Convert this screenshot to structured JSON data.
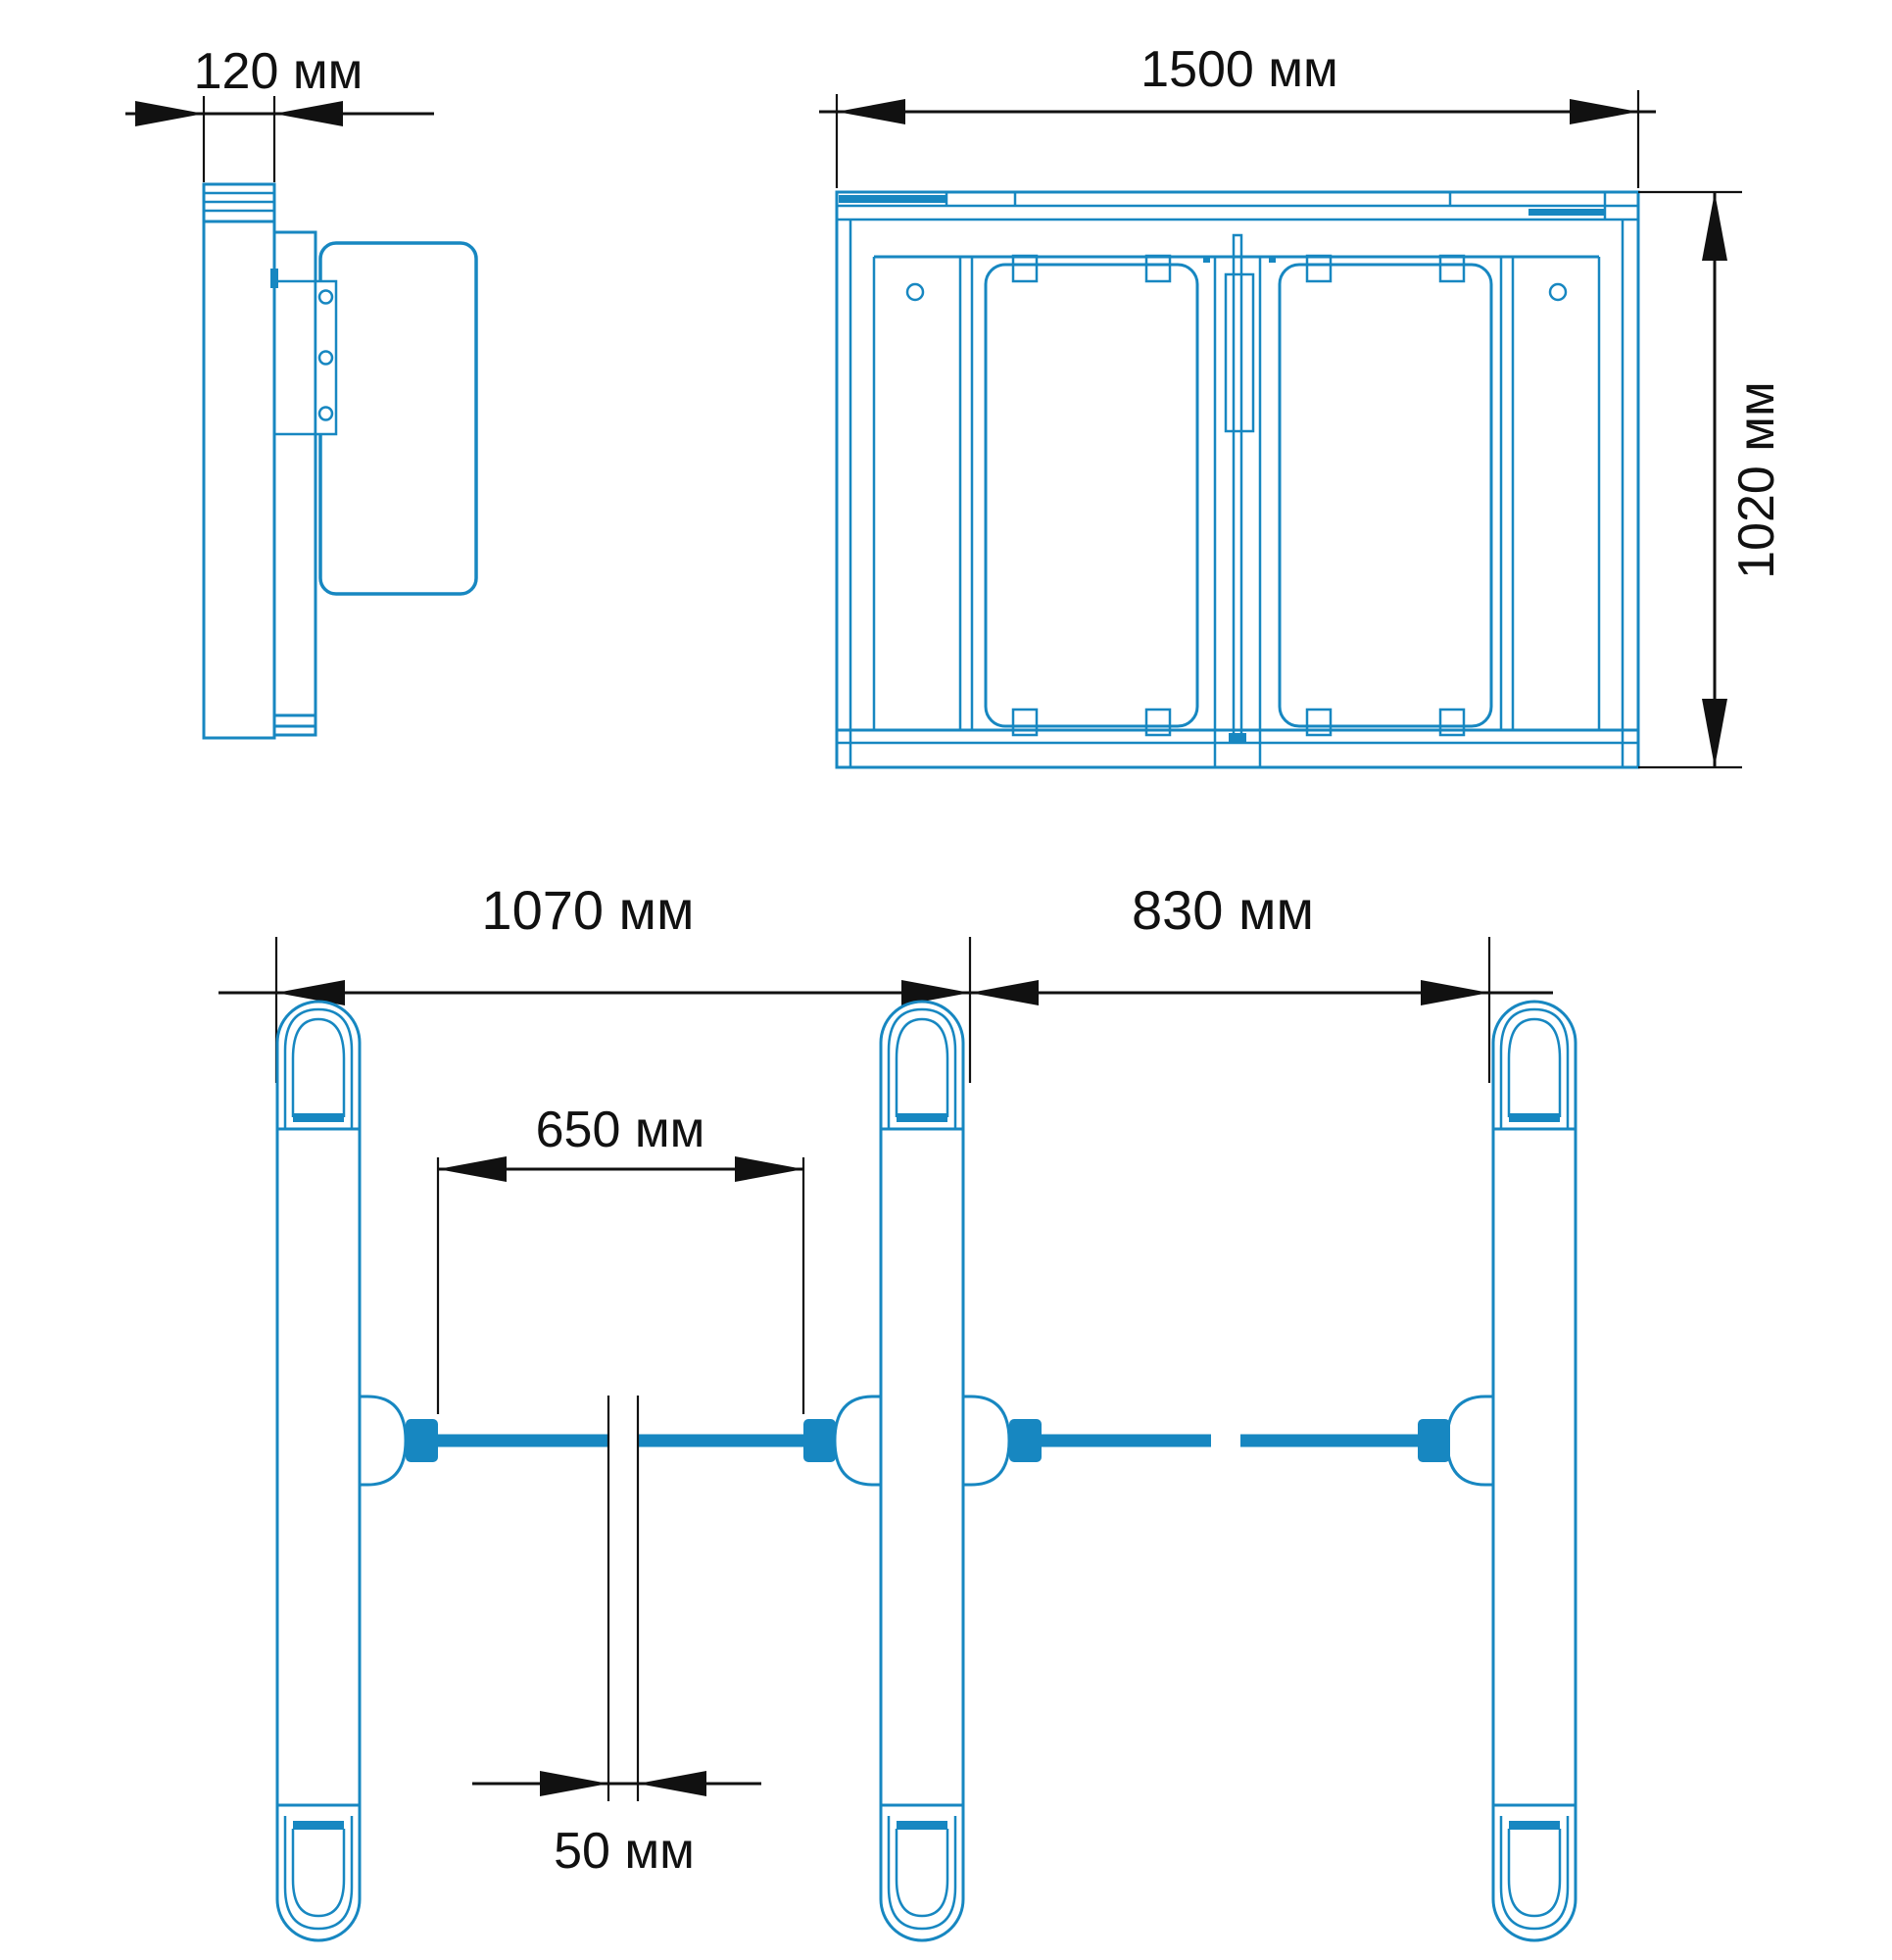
{
  "title": "Turnstile swing gate dimensional drawing",
  "unit": "мм",
  "colors": {
    "blueprint_line": "#1787c1",
    "dimension_line": "#111111",
    "background": "#ffffff"
  },
  "views": {
    "side": {
      "name": "side view",
      "dimensions": {
        "cabinet_depth": {
          "value": 120,
          "unit": "мм",
          "label": "120 мм"
        }
      }
    },
    "front": {
      "name": "front view",
      "dimensions": {
        "cabinet_length": {
          "value": 1500,
          "unit": "мм",
          "label": "1500 мм"
        },
        "cabinet_height": {
          "value": 1020,
          "unit": "мм",
          "label": "1020 мм"
        }
      }
    },
    "plan": {
      "name": "top plan view",
      "dimensions": {
        "lane_left_width": {
          "value": 1070,
          "unit": "мм",
          "label": "1070 мм"
        },
        "lane_right_width": {
          "value": 830,
          "unit": "мм",
          "label": "830 мм"
        },
        "passage_width": {
          "value": 650,
          "unit": "мм",
          "label": "650 мм"
        },
        "leaf_gap": {
          "value": 50,
          "unit": "мм",
          "label": "50 мм"
        }
      }
    }
  }
}
